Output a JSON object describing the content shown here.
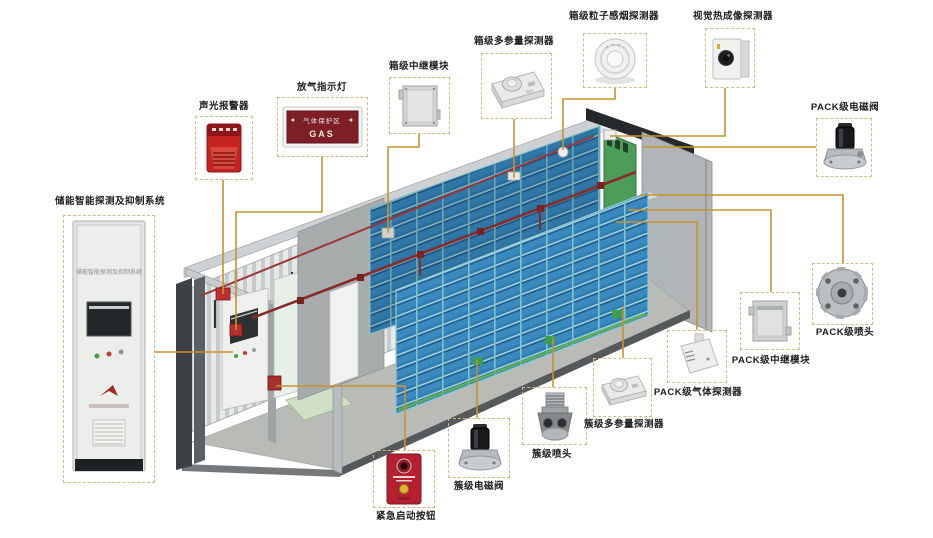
{
  "diagram": {
    "components": [
      {
        "id": "main-system",
        "label": "储能智能探测及抑制系统"
      },
      {
        "id": "sound-light-alarm",
        "label": "声光报警器"
      },
      {
        "id": "gas-release-indicator",
        "label": "放气指示灯"
      },
      {
        "id": "box-relay-module",
        "label": "箱级中继模块"
      },
      {
        "id": "box-multiparam-detector",
        "label": "箱级多参量探测器"
      },
      {
        "id": "box-smoke-detector",
        "label": "箱级粒子感烟探测器"
      },
      {
        "id": "thermal-imaging-detector",
        "label": "视觉热成像探测器"
      },
      {
        "id": "pack-solenoid-valve",
        "label": "PACK级电磁阀"
      },
      {
        "id": "pack-nozzle",
        "label": "PACK级喷头"
      },
      {
        "id": "pack-relay-module",
        "label": "PACK级中继模块"
      },
      {
        "id": "pack-gas-detector",
        "label": "PACK级气体探测器"
      },
      {
        "id": "cluster-multiparam-detector",
        "label": "簇级多参量探测器"
      },
      {
        "id": "cluster-nozzle",
        "label": "簇级喷头"
      },
      {
        "id": "cluster-solenoid-valve",
        "label": "簇级电磁阀"
      },
      {
        "id": "emergency-button",
        "label": "紧急启动按钮"
      }
    ],
    "cabinet_title": "储能智能探测及抑制系统",
    "gas_sign": {
      "zone_text": "气体保护区",
      "gas_text": "GAS"
    }
  },
  "colors": {
    "leader_line": "#c8912f",
    "callout_border": "#cdbd7e",
    "battery_blue": "#2f7fb5",
    "pipe_red": "#8a2a2a",
    "door_green": "#4d9c57",
    "alarm_red": "#c62222"
  }
}
